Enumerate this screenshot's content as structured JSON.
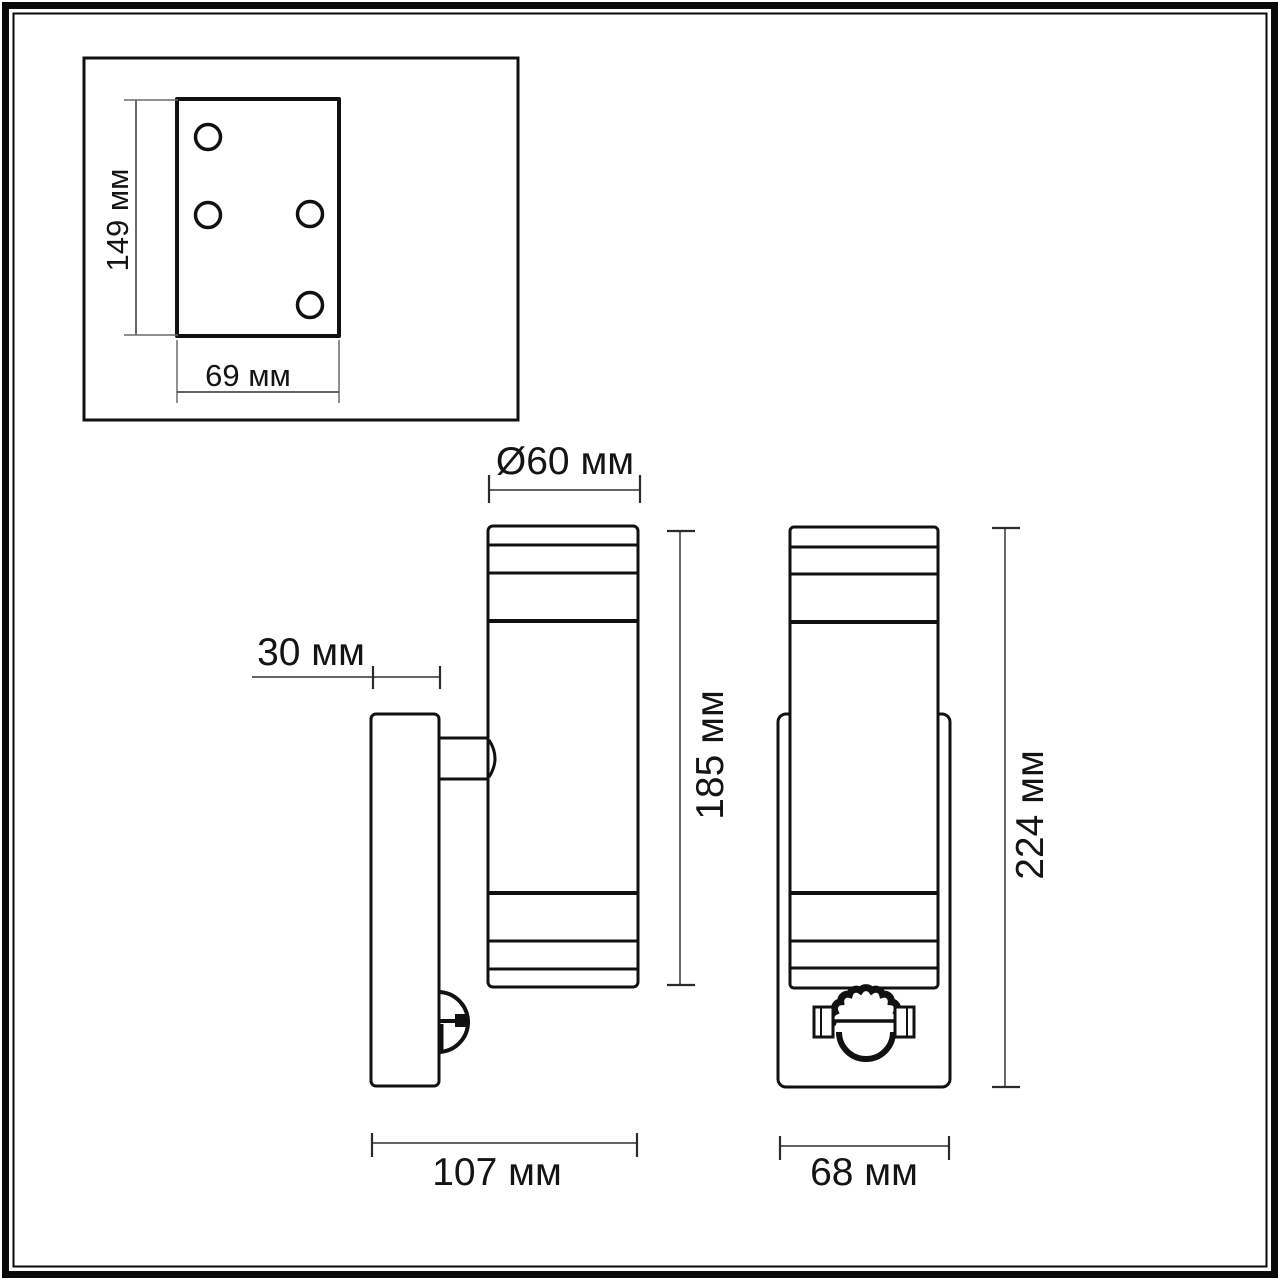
{
  "drawing": {
    "type": "technical-dimension-drawing",
    "subject": "wall-mounted cylindrical luminaire with motion sensor",
    "unit": "мм",
    "colors": {
      "background": "#ffffff",
      "object_line": "#111111",
      "dimension_line": "#4d4d4d",
      "text": "#141414"
    },
    "views": {
      "mounting_plate": {
        "label": "mounting-plate-rear-view",
        "hole_count": 4,
        "dims": {
          "height": "149 мм",
          "width": "69 мм"
        }
      },
      "side": {
        "label": "side-view",
        "dims": {
          "diameter": "Ø60 мм",
          "wall_plate_depth": "30 мм",
          "body_height": "185 мм",
          "total_depth": "107 мм"
        }
      },
      "front": {
        "label": "front-view",
        "dims": {
          "total_height": "224 мм",
          "plate_width": "68 мм"
        }
      }
    }
  }
}
